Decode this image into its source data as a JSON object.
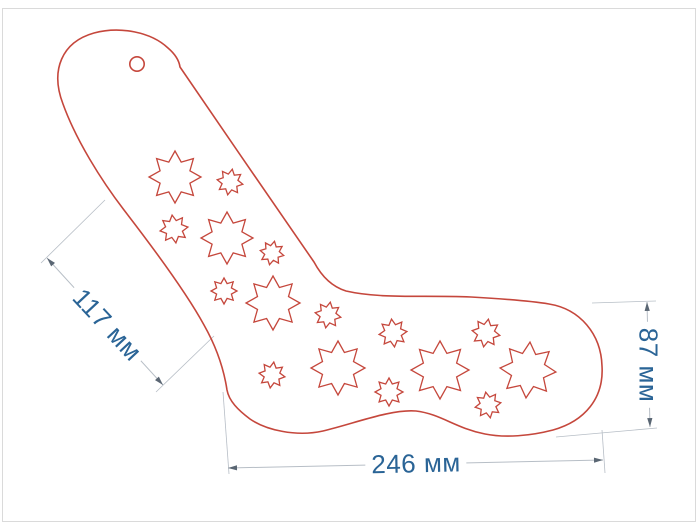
{
  "page": {
    "description": "technical drawing of a laser-cut sock blocker template with star cutouts",
    "background": "#ffffff",
    "border_color": "#dadada"
  },
  "drawing": {
    "outline_color": "#c5473c",
    "outline_width": 1.6,
    "star_stroke_width": 1.3,
    "star_points": 8,
    "star_inner_ratio": 0.62,
    "sock_path": "M 63,104 C 50,70 62,42 94,33 C 120,26 151,32 168,48 C 175,54 179,60 180,67 C 224,131 270,199 314,262 C 322,277 333,287 346,291 C 381,299 421,295 471,297 C 506,299 531,301 549,304 C 580,309 601,334 602,366 C 604,398 585,421 553,430 C 530,436 505,438 485,434 C 455,428 441,414 416,411 C 391,409 356,423 323,431 C 296,437 266,430 250,419 C 238,410 229,401 227,390 C 224,370 217,348 204,325 C 186,292 151,245 124,210 C 101,180 76,140 63,104 Z",
    "hang_hole": {
      "cx": 137,
      "cy": 64,
      "r": 7.2
    },
    "stars": [
      {
        "cx": 175,
        "cy": 177,
        "r": 26,
        "rot": 0
      },
      {
        "cx": 230,
        "cy": 182,
        "r": 13,
        "rot": 10
      },
      {
        "cx": 174,
        "cy": 229,
        "r": 14,
        "rot": -8
      },
      {
        "cx": 227,
        "cy": 238,
        "r": 26,
        "rot": 0
      },
      {
        "cx": 272,
        "cy": 253,
        "r": 12,
        "rot": 12
      },
      {
        "cx": 224,
        "cy": 291,
        "r": 13,
        "rot": 0
      },
      {
        "cx": 273,
        "cy": 303,
        "r": 27,
        "rot": 0
      },
      {
        "cx": 328,
        "cy": 315,
        "r": 13,
        "rot": 10
      },
      {
        "cx": 393,
        "cy": 333,
        "r": 14,
        "rot": -6
      },
      {
        "cx": 338,
        "cy": 368,
        "r": 27,
        "rot": 0
      },
      {
        "cx": 272,
        "cy": 375,
        "r": 13,
        "rot": 8
      },
      {
        "cx": 389,
        "cy": 392,
        "r": 14,
        "rot": 0
      },
      {
        "cx": 440,
        "cy": 370,
        "r": 29,
        "rot": 0
      },
      {
        "cx": 486,
        "cy": 333,
        "r": 14,
        "rot": 10
      },
      {
        "cx": 528,
        "cy": 370,
        "r": 28,
        "rot": 4
      },
      {
        "cx": 488,
        "cy": 405,
        "r": 13,
        "rot": -10
      }
    ]
  },
  "dimensions": {
    "text_color": "#2a6496",
    "line_color": "#b7bec6",
    "arrow_color": "#5a6673",
    "items": [
      {
        "id": "leg-length",
        "label": "117 мм",
        "line": [
          47,
          258,
          163,
          385
        ],
        "ext": [
          [
            41,
            263,
            105,
            200
          ],
          [
            156,
            392,
            214,
            336
          ]
        ],
        "tx": 107,
        "ty": 325,
        "rotate": 47
      },
      {
        "id": "toe-height",
        "label": "87 мм",
        "line": [
          647,
          302,
          650,
          427
        ],
        "ext": [
          [
            592,
            303,
            656,
            301
          ],
          [
            556,
            437,
            657,
            428
          ]
        ],
        "tx": 648,
        "ty": 365,
        "rotate": 90
      },
      {
        "id": "foot-length",
        "label": "246 мм",
        "line": [
          228,
          468,
          603,
          460
        ],
        "ext": [
          [
            223,
            392,
            229,
            474
          ],
          [
            602,
            430,
            605,
            473
          ]
        ],
        "tx": 416,
        "ty": 464,
        "rotate": -1.2
      }
    ]
  }
}
